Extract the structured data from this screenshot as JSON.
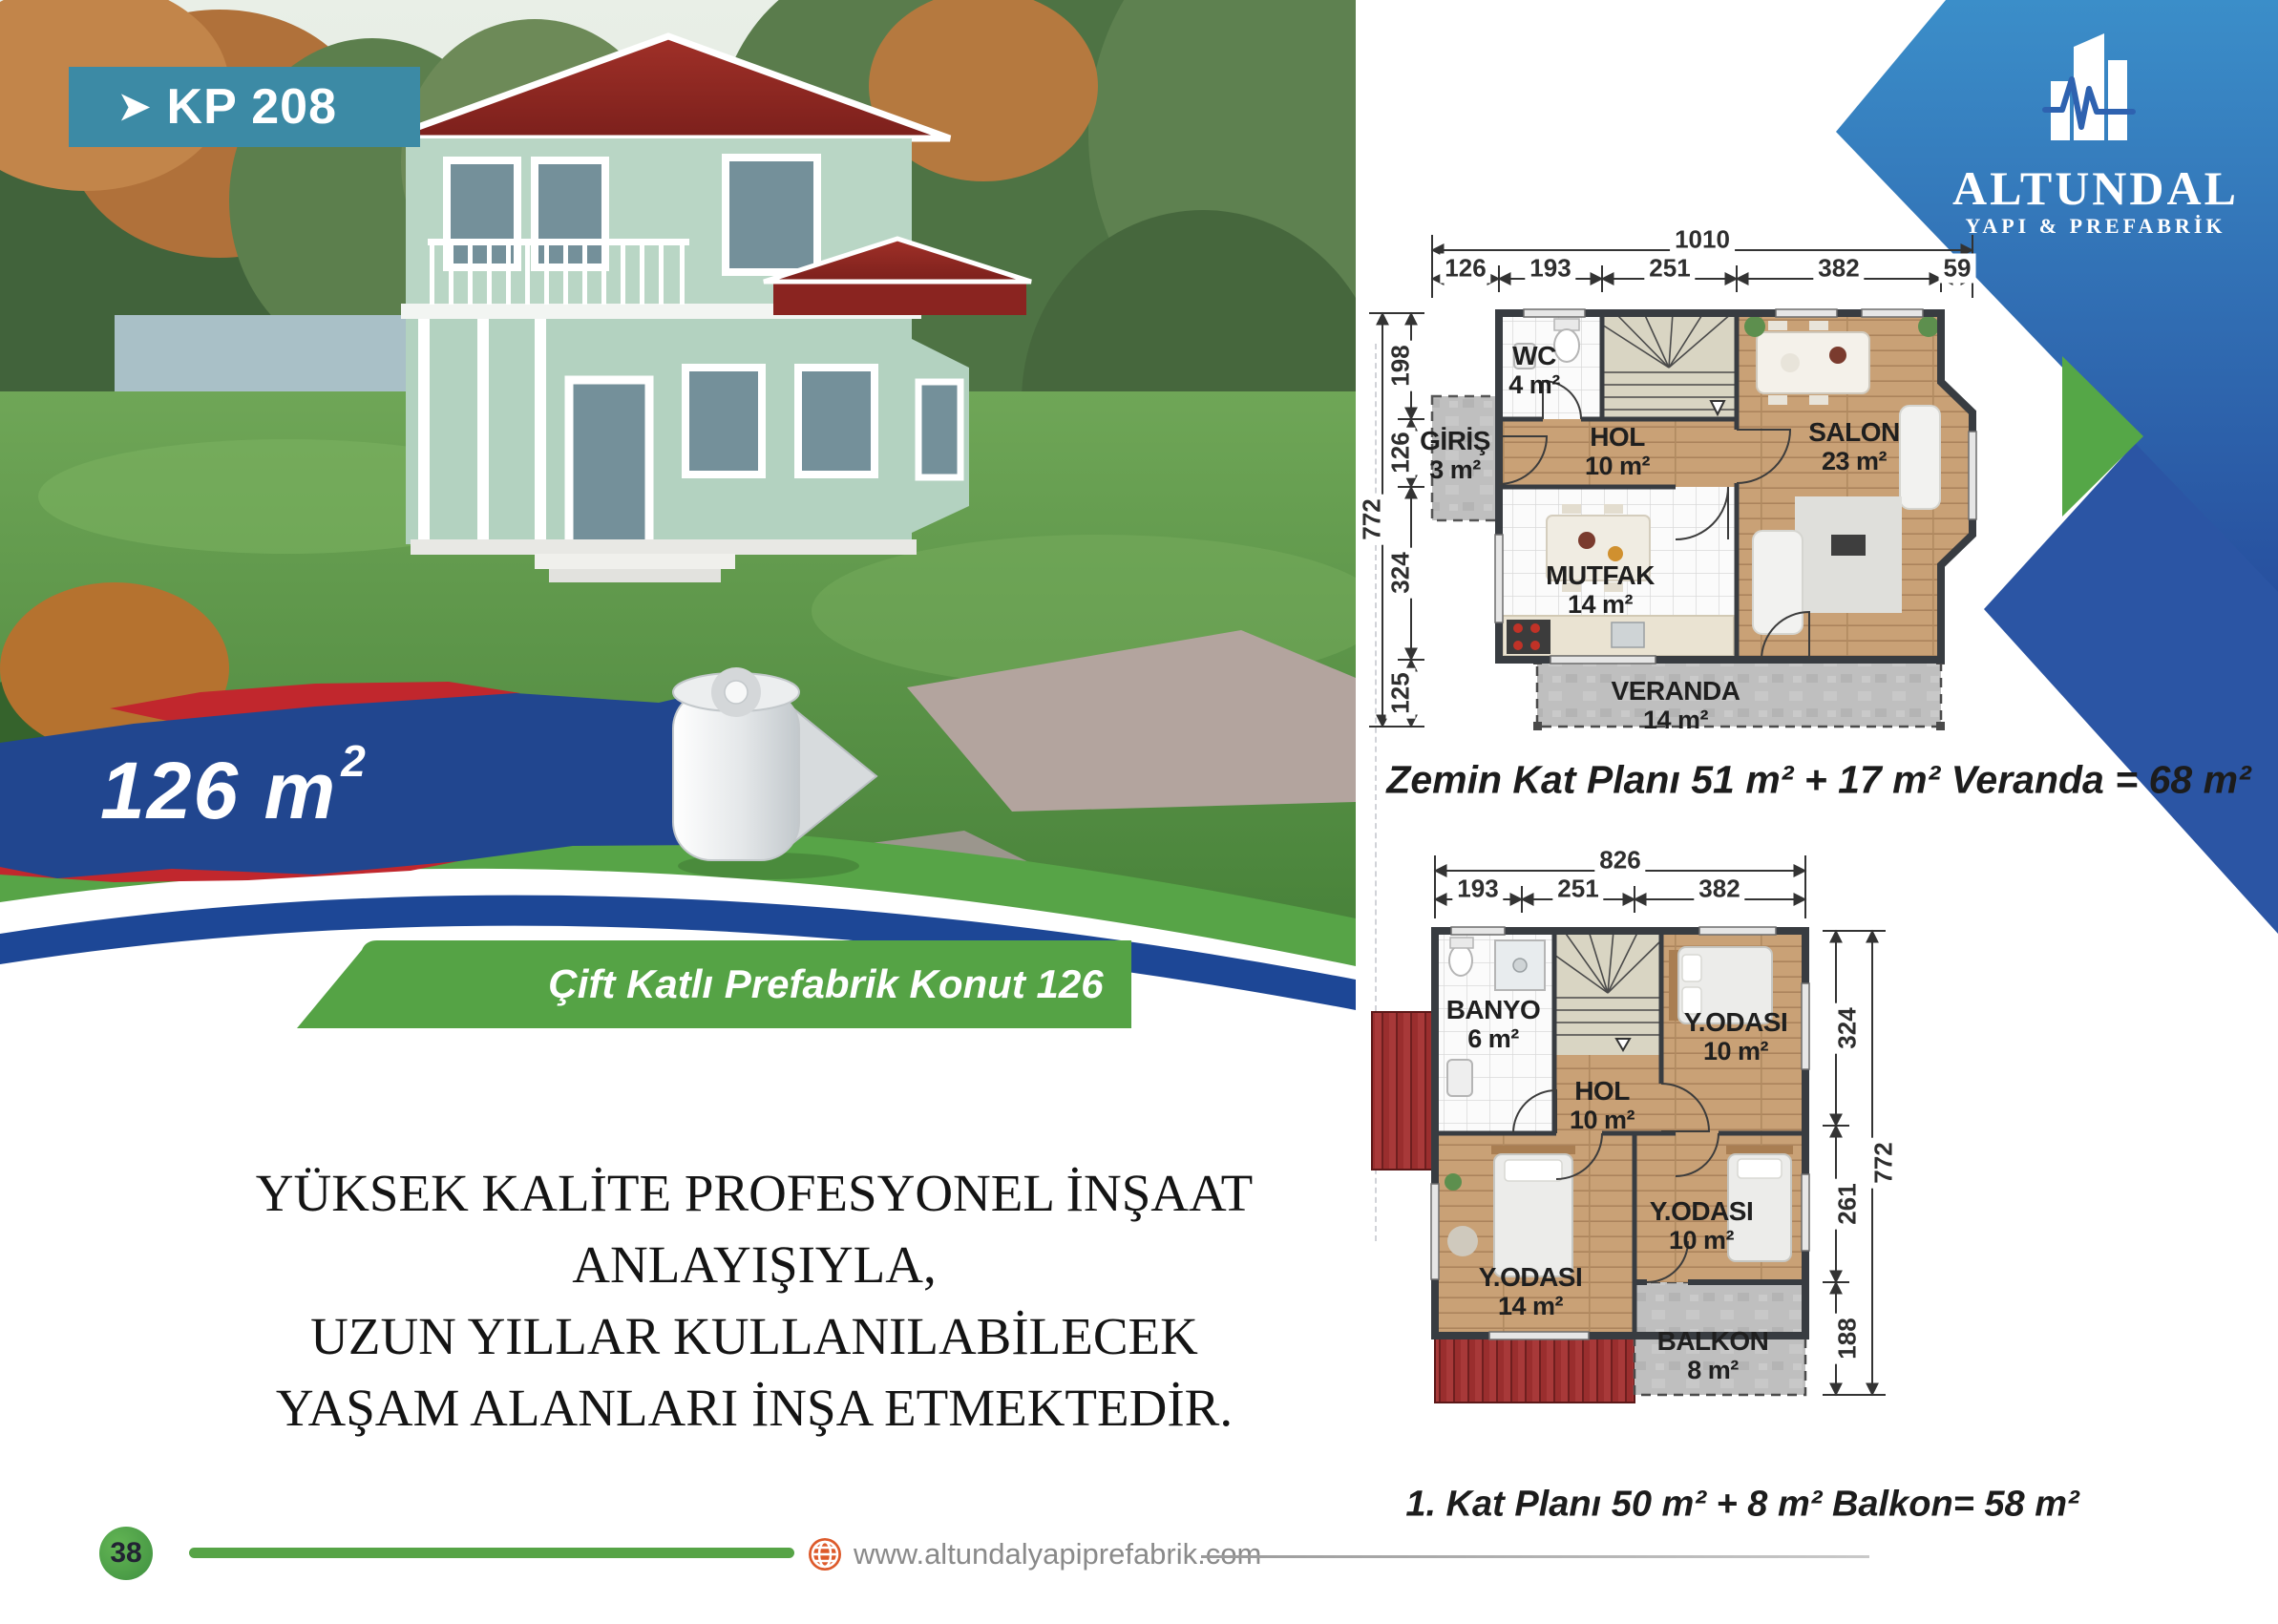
{
  "badge": {
    "arrow": "➤",
    "code": "KP 208"
  },
  "ribbon": {
    "value": "126 m",
    "sup": "2"
  },
  "logo": {
    "company": "ALTUNDAL",
    "tagline": "YAPI & PREFABRİK"
  },
  "banner": {
    "text": "Çift Katlı Prefabrik Konut 126 m",
    "sup": "2"
  },
  "description": {
    "line1": "YÜKSEK KALİTE PROFESYONEL İNŞAAT",
    "line2": "ANLAYIŞIYLA,",
    "line3": "UZUN YILLAR KULLANILABİLECEK",
    "line4": "YAŞAM ALANLARI İNŞA ETMEKTEDİR."
  },
  "ground_floor": {
    "caption": "Zemin Kat Planı 51 m² + 17 m² Veranda = 68 m²",
    "dims": {
      "total": "1010",
      "segments": [
        "126",
        "193",
        "251",
        "382",
        "59"
      ],
      "side_total": "772",
      "side_segments": [
        "198",
        "126",
        "324",
        "125"
      ]
    },
    "rooms": [
      {
        "name": "WC",
        "area": "4 m²"
      },
      {
        "name": "GİRİŞ",
        "area": "3 m²"
      },
      {
        "name": "HOL",
        "area": "10 m²"
      },
      {
        "name": "SALON",
        "area": "23 m²"
      },
      {
        "name": "MUTFAK",
        "area": "14 m²"
      },
      {
        "name": "VERANDA",
        "area": "14 m²"
      }
    ]
  },
  "first_floor": {
    "caption": "1. Kat Planı 50 m² + 8 m² Balkon= 58 m²",
    "dims": {
      "total": "826",
      "segments": [
        "193",
        "251",
        "382"
      ],
      "side_total": "772",
      "side_segments": [
        "324",
        "261",
        "188"
      ]
    },
    "rooms": [
      {
        "name": "BANYO",
        "area": "6 m²"
      },
      {
        "name": "HOL",
        "area": "10 m²"
      },
      {
        "name": "Y.ODASI",
        "area": "10 m²"
      },
      {
        "name": "Y.ODASI",
        "area": "10 m²"
      },
      {
        "name": "Y.ODASI",
        "area": "14 m²"
      },
      {
        "name": "BALKON",
        "area": "8 m²"
      }
    ]
  },
  "footer": {
    "page_number": "38",
    "website": "www.altundalyapiprefabrik.com"
  },
  "colors": {
    "accent_green": "#56a446",
    "accent_blue": "#27509f",
    "badge_teal": "#3c8aa5",
    "ribbon_red": "#c1272d",
    "ribbon_blue": "#21468f"
  }
}
